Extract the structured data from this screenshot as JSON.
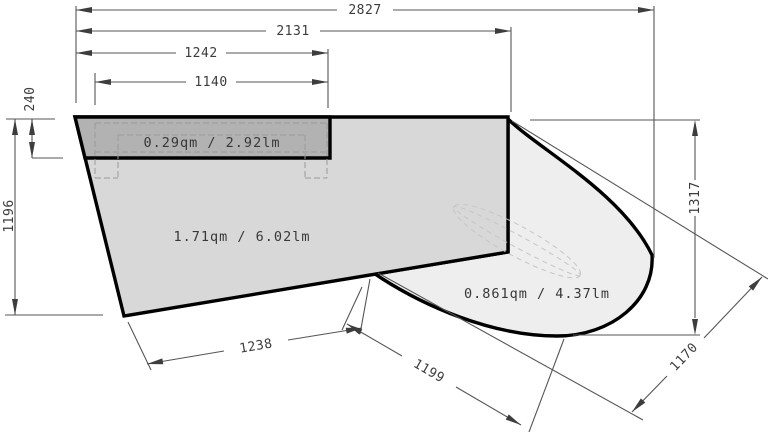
{
  "drawing": {
    "type": "dimensioned-plan",
    "units_note": "qm = square meters, lm = linear meters (labels as shown)",
    "dims": {
      "d2827": "2827",
      "d2131": "2131",
      "d1242": "1242",
      "d1140": "1140",
      "d240": "240",
      "d1196": "1196",
      "d1317": "1317",
      "d1170": "1170",
      "d1199": "1199",
      "d1238": "1238"
    },
    "areas": {
      "strip": "0.29qm / 2.92lm",
      "main": "1.71qm / 6.02lm",
      "curve": "0.861qm / 4.37lm"
    },
    "colors": {
      "outline": "#000000",
      "dimension_lines": "#565656",
      "panel_main_fill": "#d8d8d8",
      "panel_strip_fill": "#b2b2b2",
      "panel_curve_fill": "#eeeeee",
      "hidden_detail_dash": "#9a9a9a"
    }
  }
}
